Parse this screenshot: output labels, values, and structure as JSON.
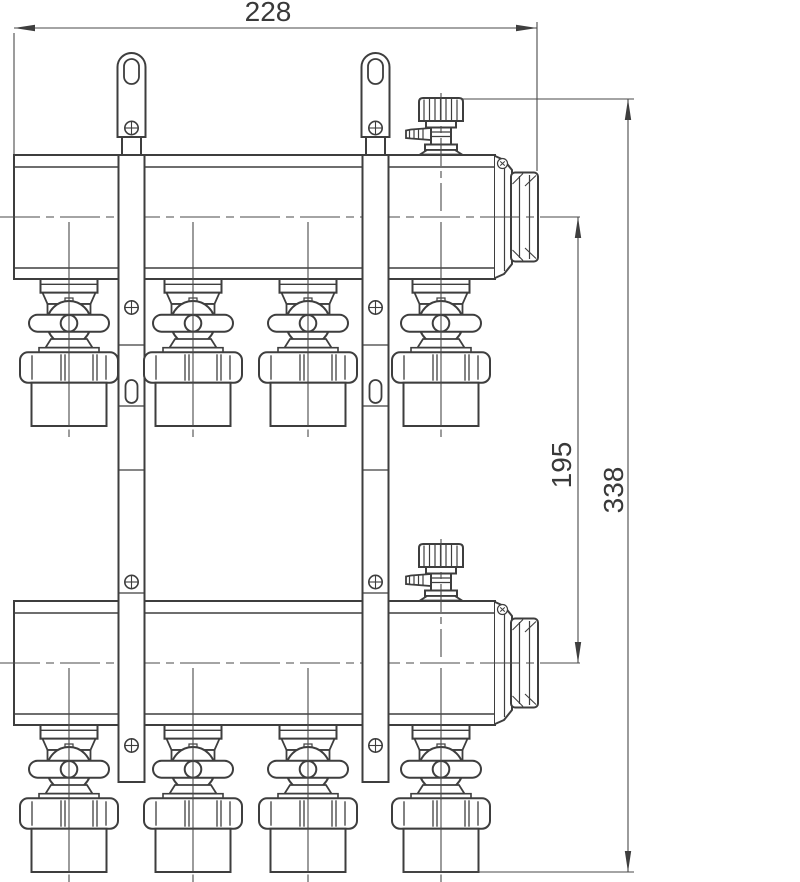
{
  "drawing": {
    "dim_width": "228",
    "dim_spacing": "195",
    "dim_height": "338",
    "colors": {
      "line": "#3e3e3e",
      "text": "#393939",
      "background": "#ffffff"
    }
  }
}
